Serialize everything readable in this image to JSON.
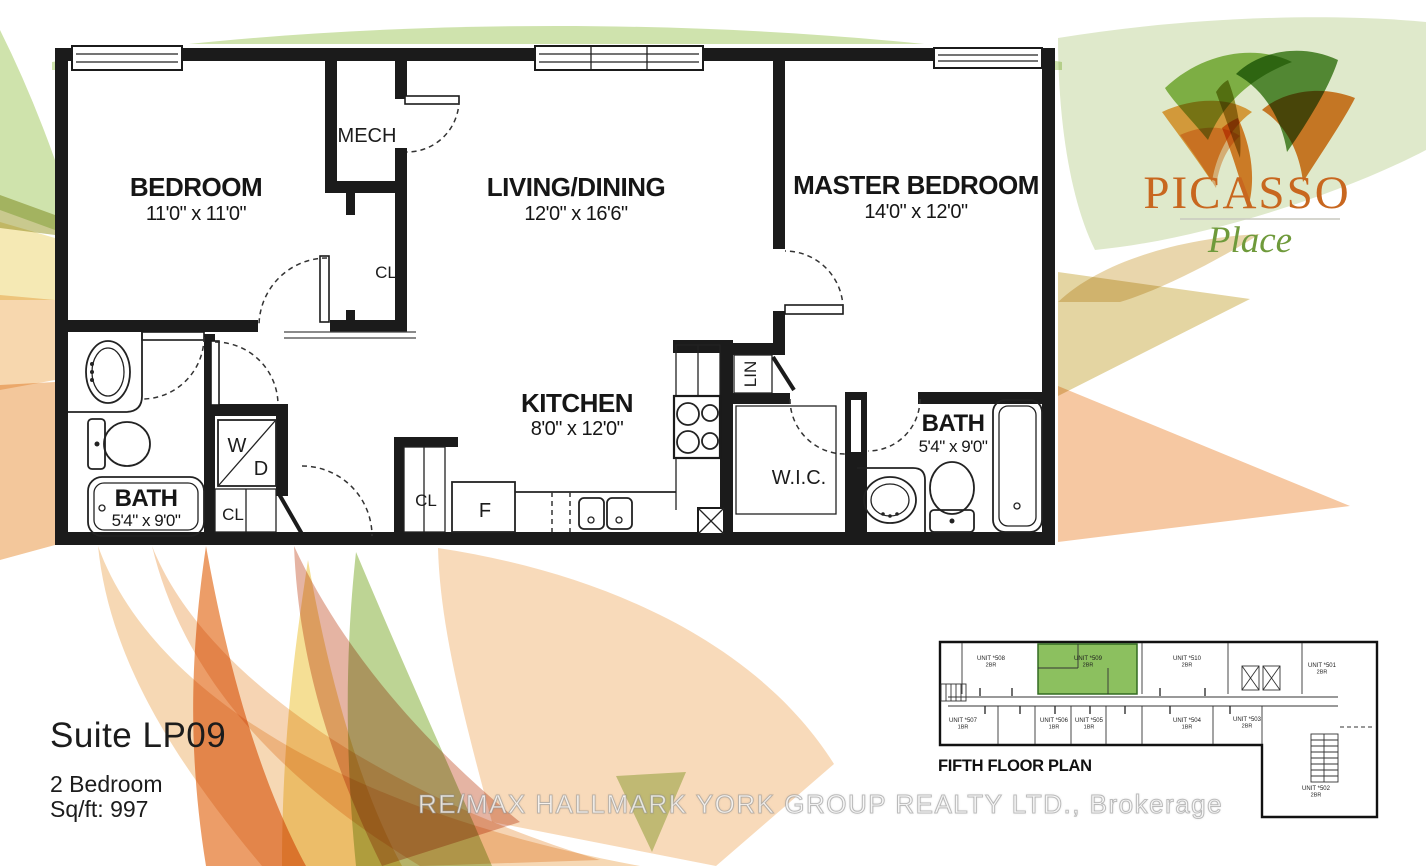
{
  "logo": {
    "title": "PICASSO",
    "subtitle": "Place"
  },
  "suite": {
    "title": "Suite LP09",
    "bedrooms": "2 Bedroom",
    "area": "Sq/ft: 997"
  },
  "watermark": {
    "text": "RE/MAX HALLMARK YORK GROUP REALTY LTD.,  Brokerage"
  },
  "plan": {
    "rooms": {
      "bedroom": {
        "name": "BEDROOM",
        "dims": "11'0\" x 11'0\""
      },
      "living": {
        "name": "LIVING/DINING",
        "dims": "12'0\" x 16'6\""
      },
      "master": {
        "name": "MASTER BEDROOM",
        "dims": "14'0\" x 12'0\""
      },
      "kitchen": {
        "name": "KITCHEN",
        "dims": "8'0\" x 12'0\""
      },
      "bath1": {
        "name": "BATH",
        "dims": "5'4\" x 9'0\""
      },
      "bath2": {
        "name": "BATH",
        "dims": "5'4\" x 9'0\""
      },
      "mech": {
        "name": "MECH"
      },
      "wic": {
        "name": "W.I.C."
      },
      "lin": {
        "name": "LIN"
      },
      "closet1": {
        "name": "CL"
      },
      "closet2": {
        "name": "CL"
      },
      "closet3": {
        "name": "CL"
      },
      "washer": {
        "name": "W"
      },
      "dryer": {
        "name": "D"
      },
      "fridge": {
        "name": "F"
      }
    }
  },
  "mini_plan": {
    "title": "FIFTH FLOOR PLAN",
    "units": [
      {
        "label": "UNIT *508",
        "type": "2BR"
      },
      {
        "label": "UNIT *509",
        "type": "2BR",
        "highlighted": true
      },
      {
        "label": "UNIT *510",
        "type": "2BR"
      },
      {
        "label": "UNIT *501",
        "type": "2BR"
      },
      {
        "label": "UNIT *507",
        "type": "1BR"
      },
      {
        "label": "UNIT *506",
        "type": "1BR"
      },
      {
        "label": "UNIT *505",
        "type": "1BR"
      },
      {
        "label": "UNIT *504",
        "type": "1BR"
      },
      {
        "label": "UNIT *503",
        "type": "2BR"
      },
      {
        "label": "UNIT *502",
        "type": "2BR"
      }
    ]
  },
  "palette": {
    "brand_orange": "#c8671f",
    "brand_green": "#6f9a3b",
    "unit_highlight": "#8cc05f",
    "wall_black": "#1b1b1b"
  }
}
